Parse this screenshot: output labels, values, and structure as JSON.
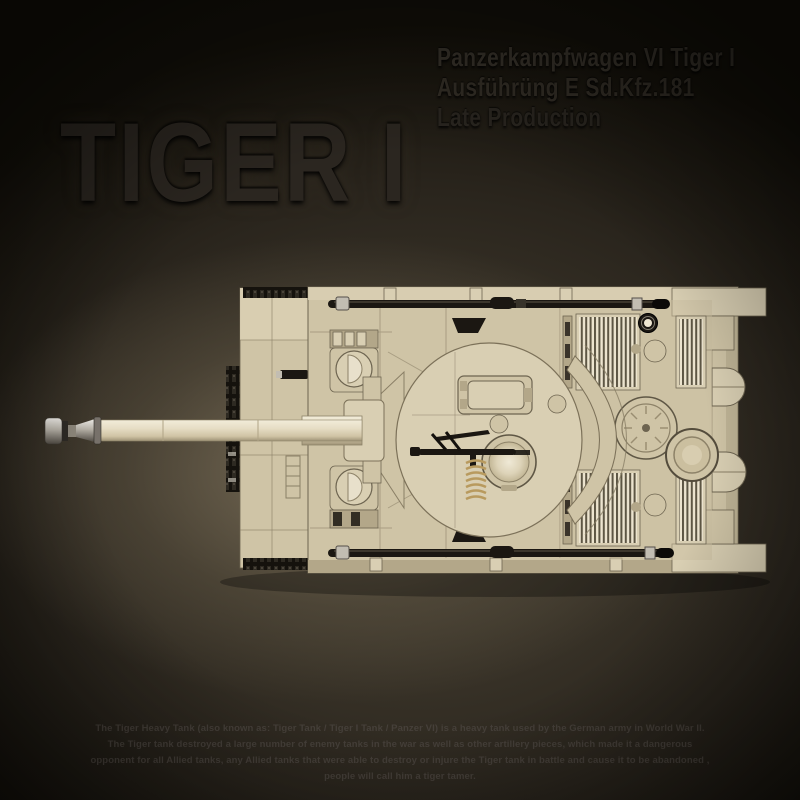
{
  "header": {
    "title": "TIGER I",
    "subtitle_lines": [
      "Panzerkampfwagen VI Tiger I",
      "Ausführüng E Sd.Kfz.181",
      "Late Production"
    ]
  },
  "footer": {
    "description": "The Tiger Heavy Tank (also known as: Tiger Tank / Tiger I Tank / Panzer VI) is a heavy tank used by the German army in World War II. The Tiger tank destroyed a large number of enemy tanks in the war as well as other artillery pieces, which made it a dangerous opponent for all Allied tanks, any Allied tanks that were able to destroy or injure the Tiger tank in battle and cause it to be abandoned , people will call him a tiger tamer."
  },
  "tank": {
    "subject": "Brick-built Tiger I heavy tank, top-down view, gun barrel pointing left",
    "parts": [
      "muzzle-brake",
      "gun-barrel",
      "gun-mantlet",
      "front-glacis",
      "left-track-links",
      "driver-hatch",
      "radio-operator-hatch",
      "turret",
      "loader-hatch",
      "commander-cupola",
      "mg34-machine-gun",
      "spring-coil",
      "turret-stowage-bin",
      "engine-deck-grilles",
      "engine-fan-cap",
      "fuel-filler-ring",
      "exhaust-covers",
      "rear-fenders",
      "tow-cable-top",
      "tow-cable-bottom"
    ]
  },
  "theme": {
    "bg-dark": "#0b0908",
    "bg-glow": "#6e6450",
    "ink-title": "#2b2620",
    "ink-sub": "#332e26",
    "ink-body": "#46403a",
    "hull": "#cfc4a6",
    "hull-light": "#d9cfb3",
    "hull-dark": "#b3a789",
    "cream": "#e7dec8",
    "dark-part": "#1b1712",
    "silver": "#c2bdb2",
    "seam": "#8a7f66",
    "gold": "#b89a5e"
  }
}
